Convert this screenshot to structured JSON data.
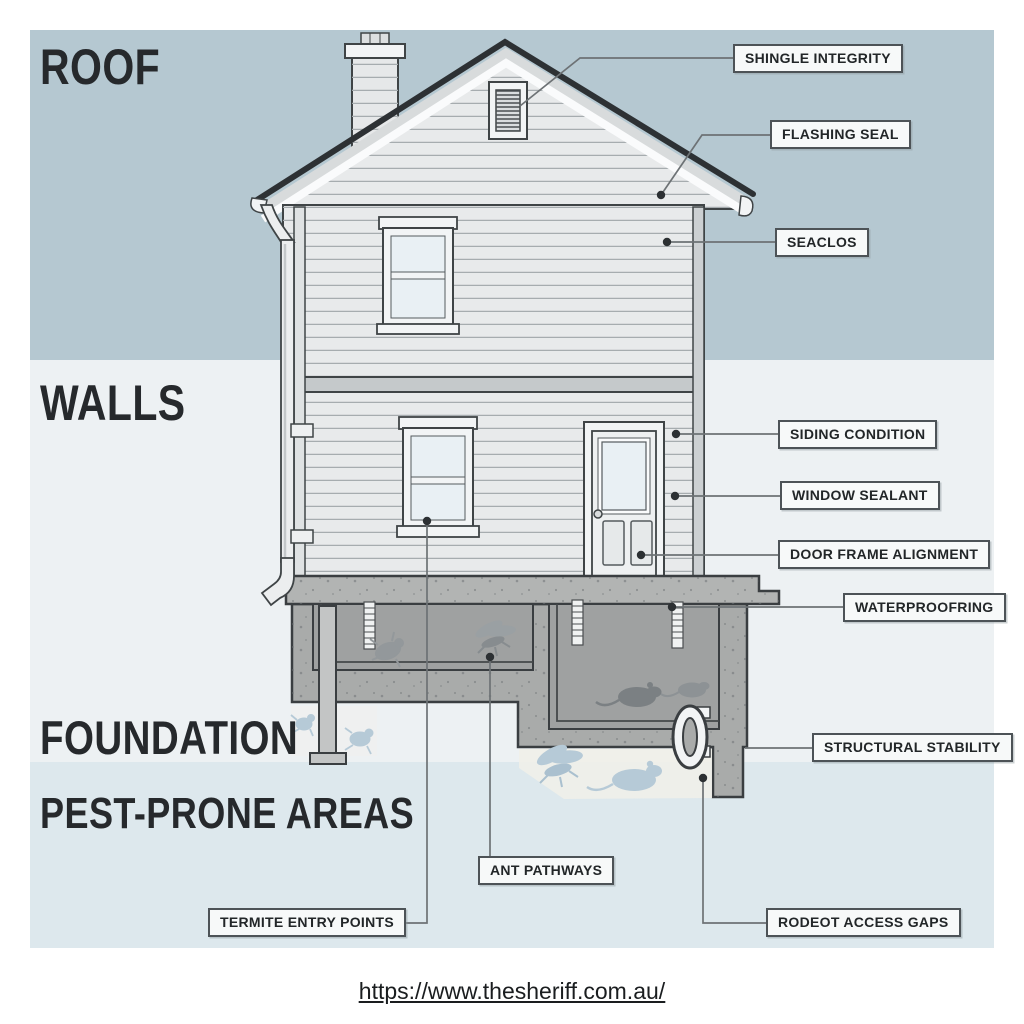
{
  "sections": [
    {
      "id": "roof",
      "label": "ROOF"
    },
    {
      "id": "walls",
      "label": "WALLS"
    },
    {
      "id": "foundation",
      "label": "FOUNDATION"
    },
    {
      "id": "pest",
      "label": "PEST-PRONE AREAS"
    }
  ],
  "callouts": [
    {
      "id": "shingle-integrity",
      "label": "SHINGLE INTEGRITY"
    },
    {
      "id": "flashing-seal",
      "label": "FLASHING SEAL"
    },
    {
      "id": "seaclos",
      "label": "SEACLOS"
    },
    {
      "id": "siding-condition",
      "label": "SIDING CONDITION"
    },
    {
      "id": "window-sealant",
      "label": "WINDOW SEALANT"
    },
    {
      "id": "door-frame-alignment",
      "label": "DOOR FRAME ALIGNMENT"
    },
    {
      "id": "waterproofring",
      "label": "WATERPROOFRING"
    },
    {
      "id": "structural-stability",
      "label": "STRUCTURAL STABILITY"
    },
    {
      "id": "ant-pathways",
      "label": "ANT PATHWAYS"
    },
    {
      "id": "termite-entry-points",
      "label": "TERMITE ENTRY POINTS"
    },
    {
      "id": "rodeot-access-gaps",
      "label": "RODEOT ACCESS GAPS"
    }
  ],
  "footer": {
    "url_text": "https://www.thesheriff.com.au/"
  },
  "colors": {
    "band_roof": "#b5c8d1",
    "band_walls": "#edf1f3",
    "band_pest": "#dde8ed",
    "margin": "#ffffff",
    "callout_line": "#6d7275",
    "label_border": "#4d5357",
    "label_bg": "#f7f9f9",
    "text": "#26292c",
    "house_outline": "#3f4446",
    "siding": "#e8eaeb",
    "roof_edge": "#2d3134",
    "concrete": "#a9abaa",
    "pest_dark": "#7b8083",
    "pest_blue": "#b6cad7"
  },
  "artwork": {
    "pests": [
      "termite-icon",
      "winged-ant-icon",
      "rat-icon"
    ],
    "house_parts": [
      "chimney",
      "attic-vent",
      "roof",
      "window",
      "door",
      "downspout",
      "foundation",
      "drain-trap"
    ]
  }
}
